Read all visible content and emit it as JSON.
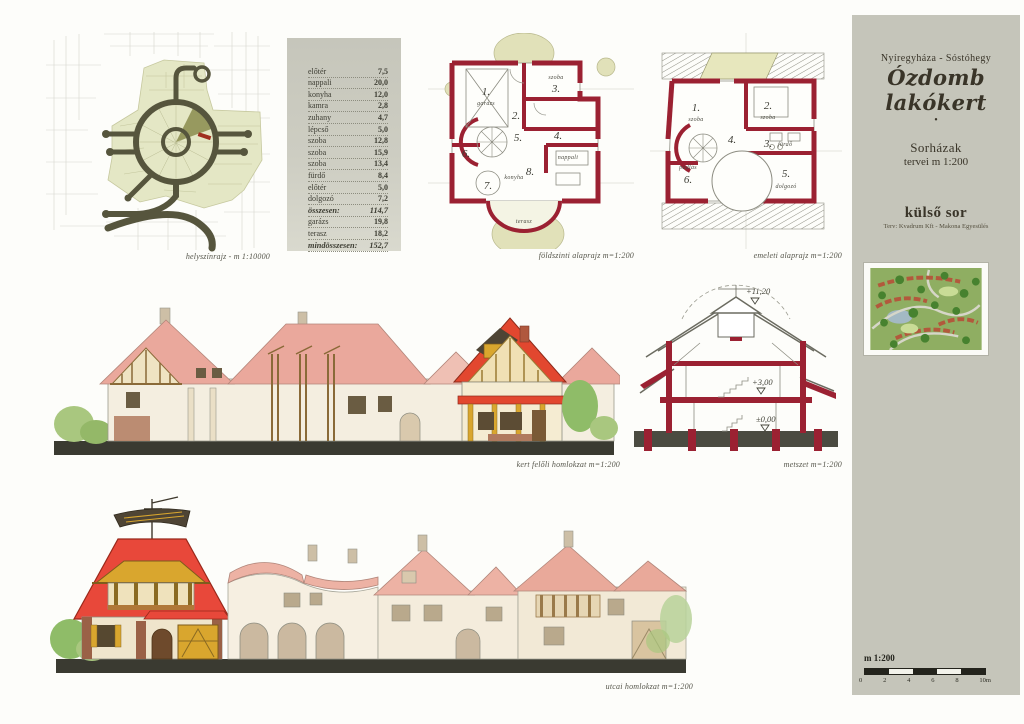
{
  "title_block": {
    "location": "Nyíregyháza - Sóstóhegy",
    "title": "Ózdomb lakókert",
    "bullet": "•",
    "series": "Sorházak",
    "series_scale": "tervei  m 1:200",
    "row_label": "külső sor",
    "credits": "Terv: Kvadrum Kft - Makona Egyesülés"
  },
  "captions": {
    "site": "helyszínrajz - m 1:10000",
    "ground_plan": "földszinti alaprajz  m=1:200",
    "upper_plan": "emeleti alaprajz  m=1:200",
    "garden_elevation": "kert felőli homlokzat  m=1:200",
    "section": "metszet  m=1:200",
    "street_elevation": "utcai homlokzat  m=1:200"
  },
  "area_table": {
    "rows": [
      {
        "label": "előtér",
        "value": "7,5"
      },
      {
        "label": "nappali",
        "value": "20,0"
      },
      {
        "label": "konyha",
        "value": "12,0"
      },
      {
        "label": "kamra",
        "value": "2,8"
      },
      {
        "label": "zuhany",
        "value": "4,7"
      },
      {
        "label": "lépcső",
        "value": "5,0"
      },
      {
        "label": "szoba",
        "value": "12,8"
      },
      {
        "label": "szoba",
        "value": "15,9"
      },
      {
        "label": "szoba",
        "value": "13,4"
      },
      {
        "label": "fürdő",
        "value": "8,4"
      },
      {
        "label": "előtér",
        "value": "5,0"
      },
      {
        "label": "dolgozó",
        "value": "7,2"
      },
      {
        "label": "összesen:",
        "value": "114,7"
      },
      {
        "label": "garázs",
        "value": "19,8"
      },
      {
        "label": "terasz",
        "value": "18,2"
      },
      {
        "label": "mindösszesen:",
        "value": "152,7"
      }
    ]
  },
  "ground_plan": {
    "rooms": [
      {
        "num": "1.",
        "name": "garázs"
      },
      {
        "num": "2.",
        "name": ""
      },
      {
        "num": "3.",
        "name": "szoba"
      },
      {
        "num": "4.",
        "name": ""
      },
      {
        "num": "5.",
        "name": ""
      },
      {
        "num": "6.",
        "name": ""
      },
      {
        "num": "7.",
        "name": "konyha"
      },
      {
        "num": "8.",
        "name": "nappali"
      }
    ],
    "terrace_label": "terasz"
  },
  "upper_plan": {
    "rooms": [
      {
        "num": "1.",
        "name": "szoba"
      },
      {
        "num": "2.",
        "name": "szoba"
      },
      {
        "num": "3.",
        "name": "fürdő"
      },
      {
        "num": "4.",
        "name": ""
      },
      {
        "num": "5.",
        "name": "dolgozó"
      },
      {
        "num": "6.",
        "name": "padlás"
      }
    ]
  },
  "section": {
    "levels": [
      "+11,20",
      "+3,00",
      "±0,00"
    ]
  },
  "scale_bar": {
    "label": "m 1:200",
    "ticks": [
      "0",
      "2",
      "4",
      "6",
      "8",
      "10m"
    ]
  },
  "colors": {
    "panel_gray": "#c5c5ba",
    "wall_red": "#9b2132",
    "roof_highlight_red": "#e8483a",
    "roof_pale_salmon": "#eaa89c",
    "timber_yellow": "#d9a62e",
    "site_green": "#e4e7c5",
    "road_olive": "#56553d",
    "ground_dark": "#3a3a31"
  }
}
